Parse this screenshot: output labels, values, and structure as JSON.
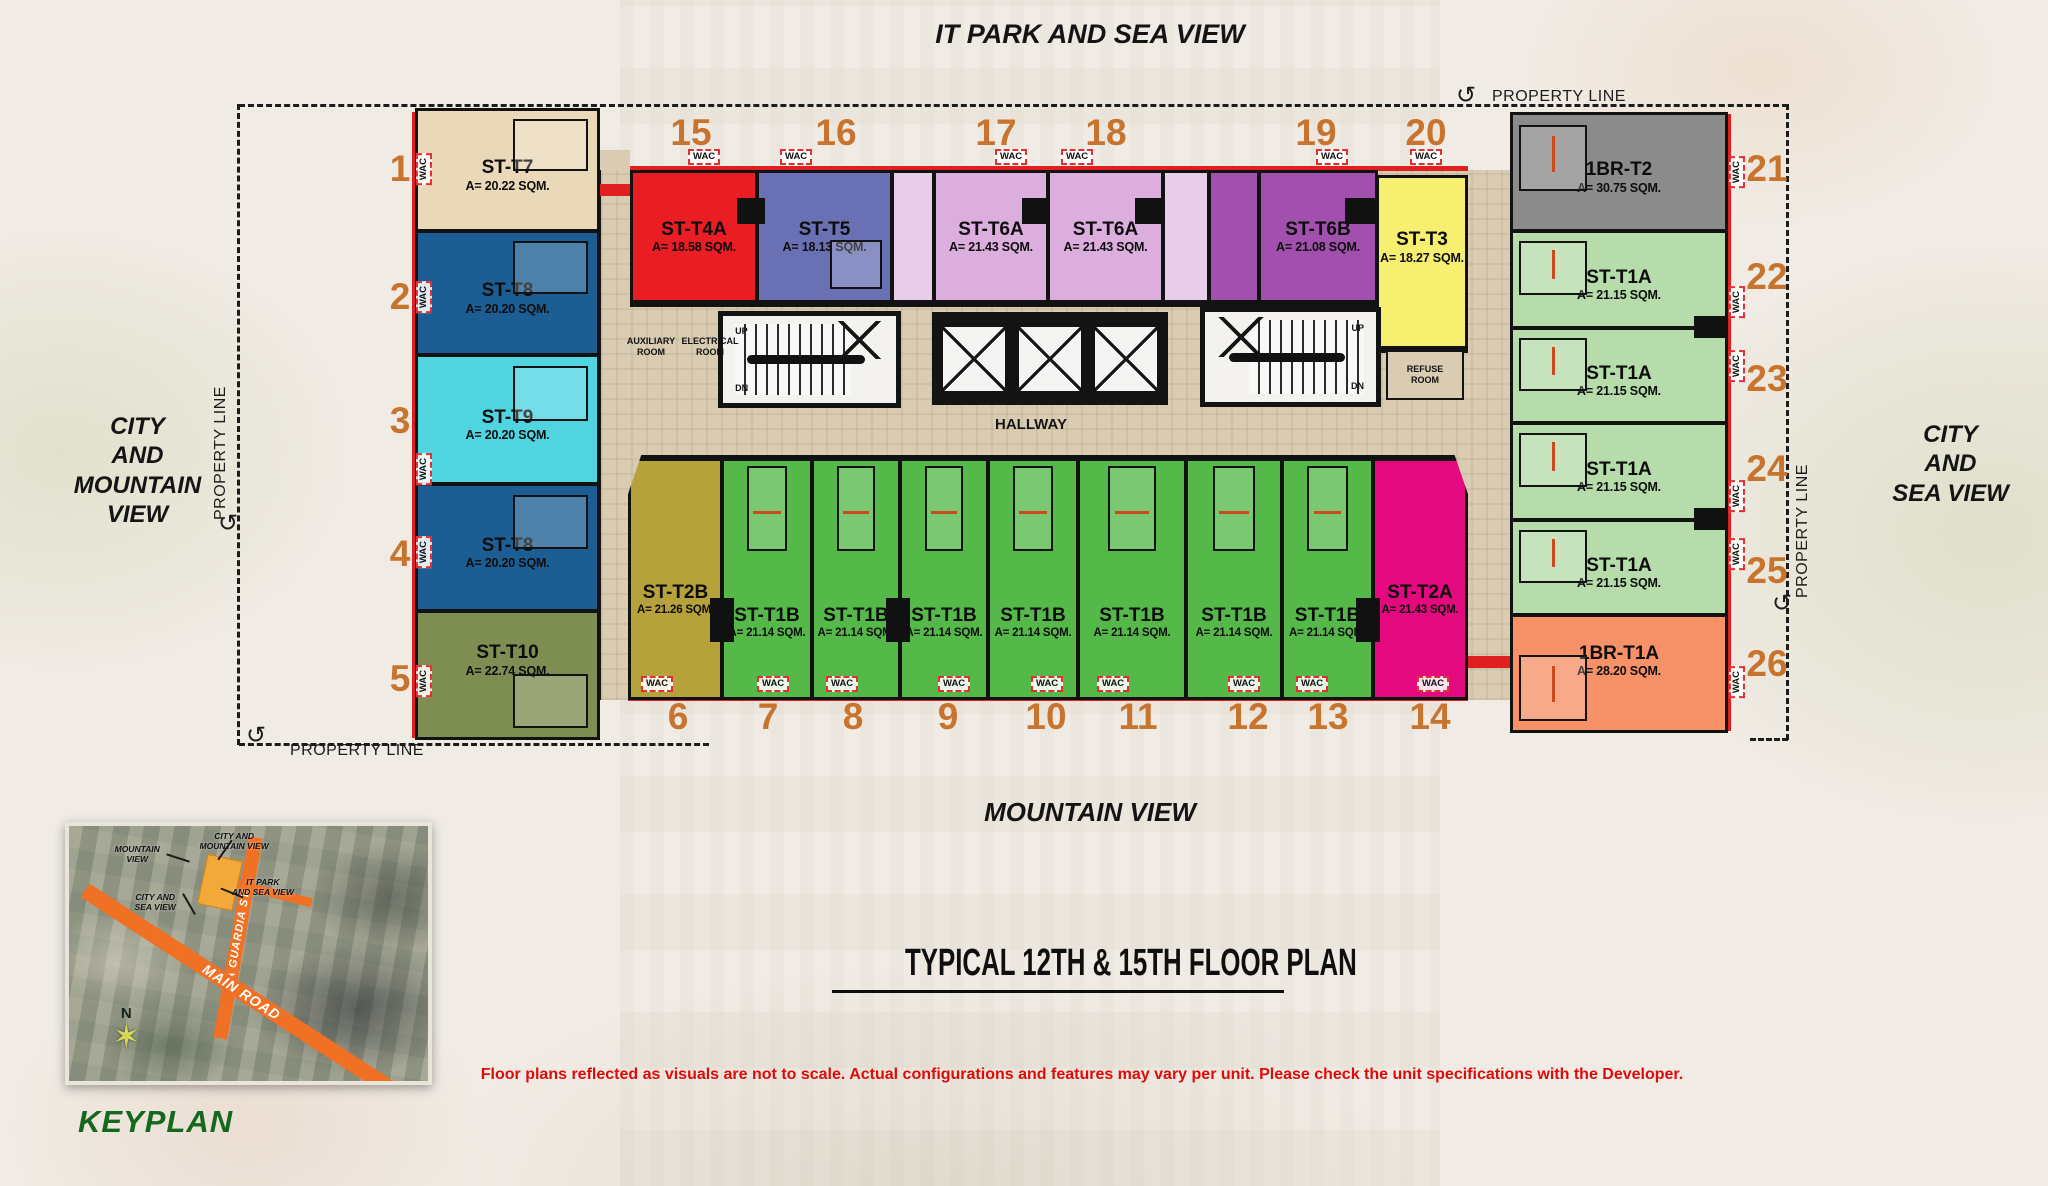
{
  "title": "TYPICAL 12TH & 15TH FLOOR PLAN",
  "disclaimer": "Floor plans reflected as visuals are not to scale. Actual configurations and features may vary per unit. Please check the unit specifications with the Developer.",
  "property_line": "PROPERTY LINE",
  "views": {
    "top": "IT PARK AND SEA VIEW",
    "left": "CITY\nAND\nMOUNTAIN\nVIEW",
    "right": "CITY\nAND\nSEA VIEW",
    "bottom": "MOUNTAIN VIEW"
  },
  "labels": {
    "wac": "WAC",
    "hallway": "HALLWAY",
    "auxiliary_room": "AUXILIARY\nROOM",
    "electrical_room": "ELECTRICAL\nROOM",
    "refuse_room": "REFUSE\nROOM",
    "up": "UP",
    "dn": "DN"
  },
  "keyplan": {
    "label": "KEYPLAN",
    "compass": "N",
    "roads": {
      "vertical": "LA GUARDIA ST.",
      "main": "MAIN ROAD"
    },
    "callouts": {
      "mountain": "MOUNTAIN\nVIEW",
      "city_mountain": "CITY AND\nMOUNTAIN VIEW",
      "it_park_sea": "IT PARK\nAND SEA VIEW",
      "city_sea": "CITY AND\nSEA VIEW"
    }
  },
  "colors": {
    "number_orange": "#c8742e",
    "wall_black": "#121212",
    "corridor_tan": "#d9ccb2",
    "accent_red": "#e02020",
    "disclaimer_red": "#de0b0b",
    "keyplan_green": "#15691f",
    "road_orange": "#f07024"
  },
  "units": [
    {
      "num": "1",
      "name": "ST-T7",
      "area": "A= 20.22 SQM.",
      "color": "#ead9b8"
    },
    {
      "num": "2",
      "name": "ST-T8",
      "area": "A= 20.20 SQM.",
      "color": "#1c5e93"
    },
    {
      "num": "3",
      "name": "ST-T9",
      "area": "A= 20.20 SQM.",
      "color": "#4fd4e0"
    },
    {
      "num": "4",
      "name": "ST-T8",
      "area": "A= 20.20 SQM.",
      "color": "#1c5e93"
    },
    {
      "num": "5",
      "name": "ST-T10",
      "area": "A= 22.74 SQM.",
      "color": "#7e8e52"
    },
    {
      "num": "15",
      "name": "ST-T4A",
      "area": "A= 18.58 SQM.",
      "color": "#ea1c24"
    },
    {
      "num": "16",
      "name": "ST-T5",
      "area": "A= 18.13 SQM.",
      "color": "#6a70b4"
    },
    {
      "num": "17",
      "name": "ST-T6A",
      "area": "A= 21.43 SQM.",
      "color": "#dcaede"
    },
    {
      "num": "18",
      "name": "ST-T6A",
      "area": "A= 21.43 SQM.",
      "color": "#dcaede"
    },
    {
      "num": "19",
      "name": "ST-T6B",
      "area": "A= 21.08 SQM.",
      "color": "#a150ae"
    },
    {
      "num": "20",
      "name": "ST-T3",
      "area": "A= 18.27 SQM.",
      "color": "#f6ef6f"
    },
    {
      "num": "21",
      "name": "1BR-T2",
      "area": "A= 30.75 SQM.",
      "color": "#8b8b8b"
    },
    {
      "num": "22",
      "name": "ST-T1A",
      "area": "A= 21.15 SQM.",
      "color": "#b6dcac"
    },
    {
      "num": "23",
      "name": "ST-T1A",
      "area": "A= 21.15 SQM.",
      "color": "#b6dcac"
    },
    {
      "num": "24",
      "name": "ST-T1A",
      "area": "A= 21.15 SQM.",
      "color": "#b6dcac"
    },
    {
      "num": "25",
      "name": "ST-T1A",
      "area": "A= 21.15 SQM.",
      "color": "#b6dcac"
    },
    {
      "num": "26",
      "name": "1BR-T1A",
      "area": "A= 28.20 SQM.",
      "color": "#f69168"
    },
    {
      "num": "6",
      "name": "ST-T2B",
      "area": "A= 21.26 SQM.",
      "color": "#b5a23b"
    },
    {
      "num": "7",
      "name": "ST-T1B",
      "area": "A= 21.14 SQM.",
      "color": "#55b94a"
    },
    {
      "num": "8",
      "name": "ST-T1B",
      "area": "A= 21.14 SQM.",
      "color": "#55b94a"
    },
    {
      "num": "9",
      "name": "ST-T1B",
      "area": "A= 21.14 SQM.",
      "color": "#55b94a"
    },
    {
      "num": "10",
      "name": "ST-T1B",
      "area": "A= 21.14 SQM.",
      "color": "#55b94a"
    },
    {
      "num": "11",
      "name": "ST-T1B",
      "area": "A= 21.14 SQM.",
      "color": "#55b94a"
    },
    {
      "num": "12",
      "name": "ST-T1B",
      "area": "A= 21.14 SQM.",
      "color": "#55b94a"
    },
    {
      "num": "13",
      "name": "ST-T1B",
      "area": "A= 21.14 SQM.",
      "color": "#55b94a"
    },
    {
      "num": "14",
      "name": "ST-T2A",
      "area": "A= 21.43 SQM.",
      "color": "#e4097e"
    }
  ]
}
